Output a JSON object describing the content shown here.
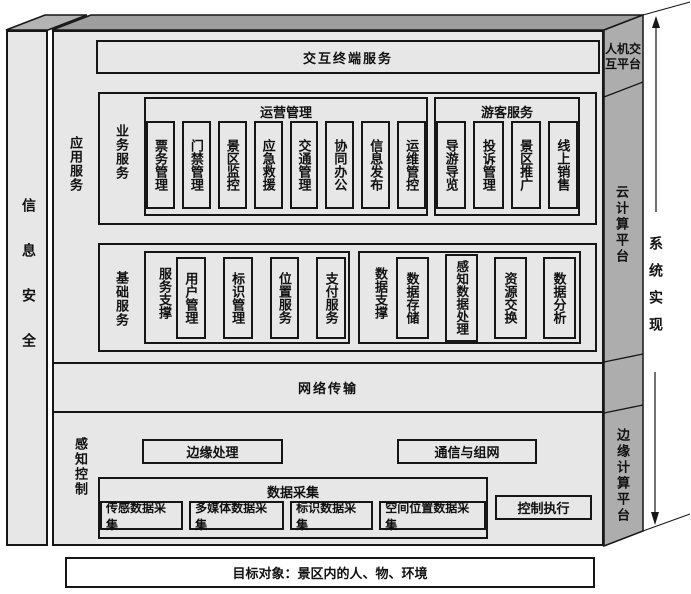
{
  "colors": {
    "background": "#ffffff",
    "front_face": "#e7e7e7",
    "top_face": "#9e9e9e",
    "left_top_face": "#b3b3b3",
    "side_face": "#adadad",
    "border": "#161616"
  },
  "security": {
    "label": "信息安全"
  },
  "implementation": {
    "label": "系统实现"
  },
  "platforms": {
    "hmi": "人机交互平台",
    "cloud": "云计算平台",
    "edge": "边缘计算平台"
  },
  "application": {
    "label": "应用服务",
    "terminal": "交互终端服务",
    "business": {
      "label": "业务服务",
      "operation": {
        "label": "运营管理",
        "items": [
          "票务管理",
          "门禁管理",
          "景区监控",
          "应急救援",
          "交通管理",
          "协同办公",
          "信息发布",
          "运维管控"
        ]
      },
      "visitor": {
        "label": "游客服务",
        "items": [
          "导游导览",
          "投诉管理",
          "景区推广",
          "线上销售"
        ]
      }
    },
    "foundation": {
      "label": "基础服务",
      "service_support": {
        "label": "服务支撑",
        "items": [
          "用户管理",
          "标识管理",
          "位置服务",
          "支付服务"
        ]
      },
      "data_support": {
        "label": "数据支撑",
        "items": [
          "数据存储",
          "感知数据处理",
          "资源交换",
          "数据分析"
        ]
      }
    }
  },
  "network": {
    "label": "网络传输"
  },
  "perception": {
    "label": "感知控制",
    "edge_processing": "边缘处理",
    "networking": "通信与组网",
    "collection": {
      "label": "数据采集",
      "items": [
        "传感数据采集",
        "多媒体数据采集",
        "标识数据采集",
        "空间位置数据采集"
      ]
    },
    "control": "控制执行"
  },
  "target": {
    "label": "目标对象：景区内的人、物、环境"
  }
}
